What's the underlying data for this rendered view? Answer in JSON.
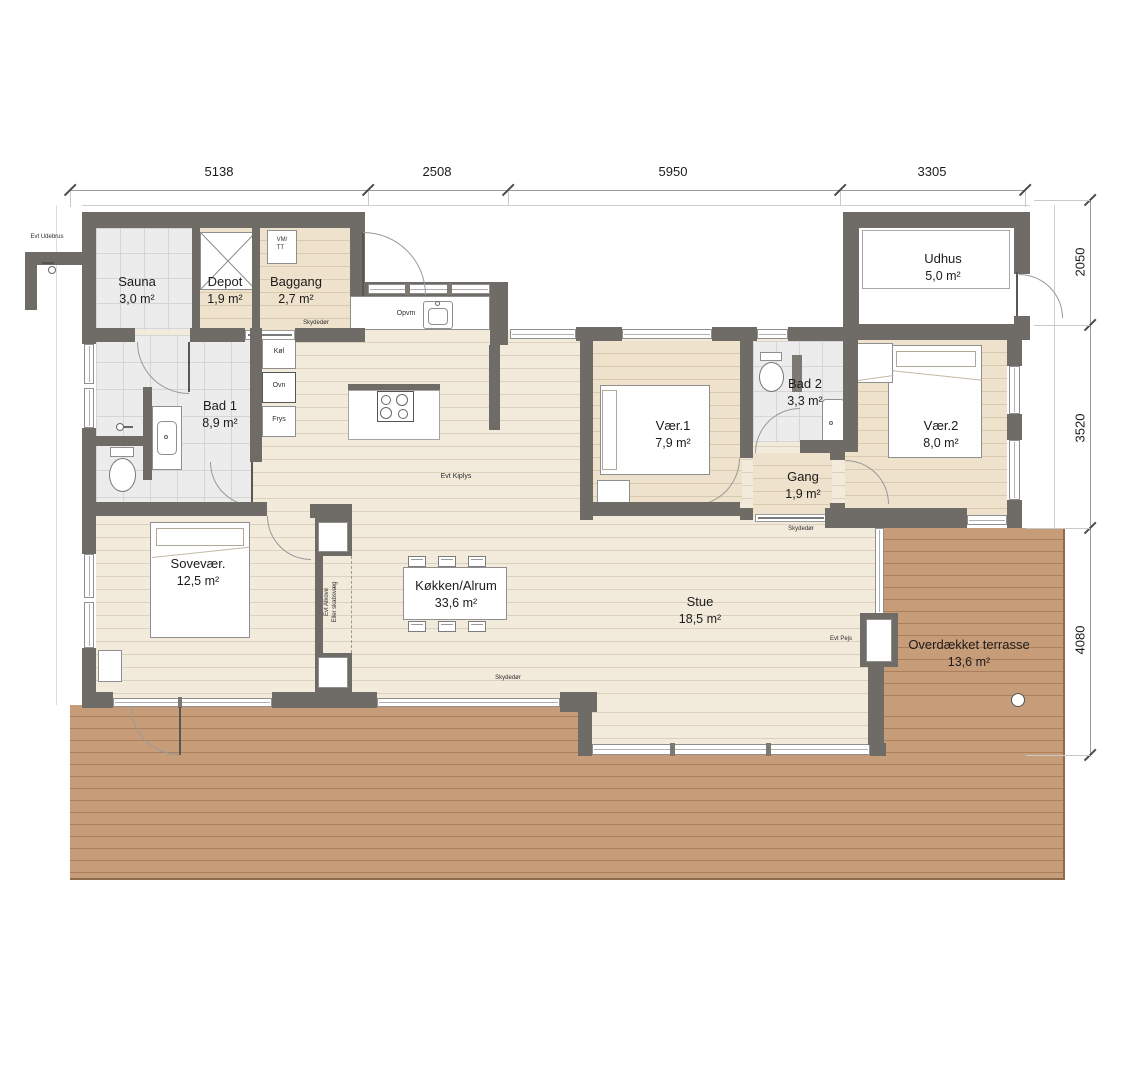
{
  "dimensions": {
    "top": [
      "5138",
      "2508",
      "5950",
      "3305"
    ],
    "right": [
      "2050",
      "3520",
      "4080"
    ]
  },
  "rooms": {
    "sauna": {
      "name": "Sauna",
      "area": "3,0 m²"
    },
    "depot": {
      "name": "Depot",
      "area": "1,9 m²"
    },
    "baggang": {
      "name": "Baggang",
      "area": "2,7 m²"
    },
    "udhus": {
      "name": "Udhus",
      "area": "5,0 m²"
    },
    "bad1": {
      "name": "Bad 1",
      "area": "8,9 m²"
    },
    "vaer1": {
      "name": "Vær.1",
      "area": "7,9 m²"
    },
    "bad2": {
      "name": "Bad 2",
      "area": "3,3 m²"
    },
    "gang": {
      "name": "Gang",
      "area": "1,9 m²"
    },
    "vaer2": {
      "name": "Vær.2",
      "area": "8,0 m²"
    },
    "sovevaer": {
      "name": "Sovevær.",
      "area": "12,5 m²"
    },
    "kokken": {
      "name": "Køkken/Alrum",
      "area": "33,6 m²"
    },
    "stue": {
      "name": "Stue",
      "area": "18,5 m²"
    },
    "terrasse": {
      "name": "Overdækket terrasse",
      "area": "13,6 m²"
    }
  },
  "annotations": {
    "evt_udebrus": "Evt Udebrus",
    "skydedor": "Skydedør",
    "opvm": "Opvm",
    "kol": "Køl",
    "ovn": "Ovn",
    "frys": "Frys",
    "vm": "VM/",
    "tt": "TT",
    "evt_kiplys": "Evt Kiplys",
    "evt_alkove_1": "Evt Alkove",
    "evt_alkove_2": "Eller skabsvæg",
    "evt_pejs": "Evt Pejs"
  },
  "colors": {
    "wall": "#6f6b66",
    "floor_main": "#f2ebdc",
    "floor_warm": "#eee2cc",
    "deck": "#c79c79",
    "tile": "#ececec"
  }
}
